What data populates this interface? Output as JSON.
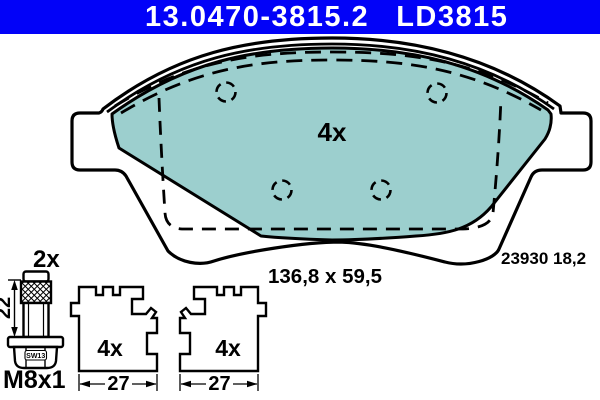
{
  "header": {
    "part_number": "13.0470-3815.2",
    "variant_code": "LD3815"
  },
  "pad_assembly": {
    "quantity": "4x",
    "size": "136,8 x 59,5",
    "wva_number": "23930 18,2"
  },
  "bolt": {
    "quantity": "2x",
    "length": "22",
    "wrench_size": "SW13",
    "thread": "M8x1"
  },
  "clip_left": {
    "quantity": "4x",
    "width": "27"
  },
  "clip_right": {
    "quantity": "4x",
    "width": "27"
  },
  "colors": {
    "header_bg": "#0202f8",
    "header_text": "#ffffff",
    "pad_fill": "#9ccfce",
    "line": "#000000"
  }
}
